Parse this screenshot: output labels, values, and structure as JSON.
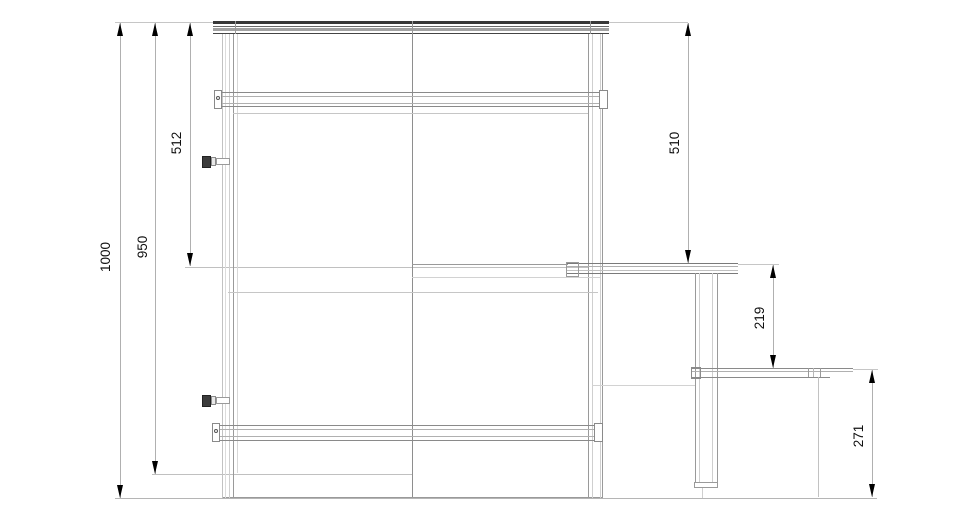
{
  "dimensions": {
    "overall_height": {
      "label": "1000"
    },
    "frame_height": {
      "label": "950"
    },
    "left_upper_span": {
      "label": "512"
    },
    "right_upper_span": {
      "label": "510"
    },
    "desk_to_step": {
      "label": "219"
    },
    "step_to_floor": {
      "label": "271"
    }
  },
  "colors": {
    "background": "#ffffff",
    "dimension_text": "#111111",
    "arrow": "#000000",
    "dimension_line": "#b0b0b0",
    "structure_dark": "#383838",
    "structure_medium": "#9a9a9a",
    "structure_light": "#cfcfcf"
  }
}
